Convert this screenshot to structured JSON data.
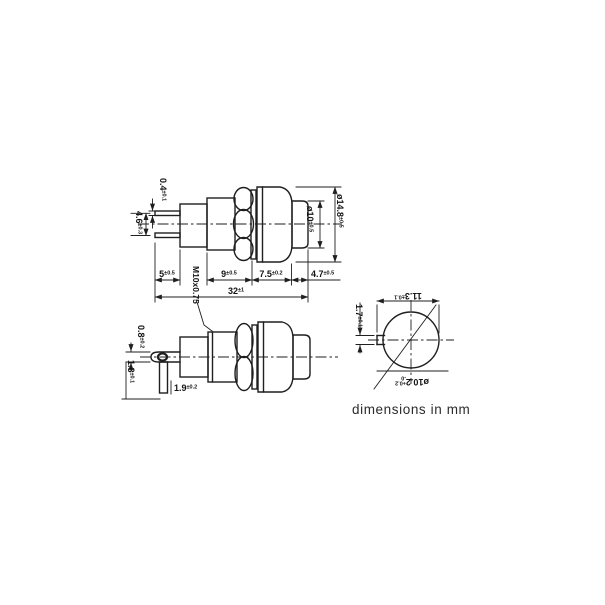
{
  "note": "dimensions in mm",
  "colors": {
    "ink": "#1f1f1f",
    "paper": "#ffffff"
  },
  "views": {
    "front_side_view": {
      "dims": {
        "terminal_thickness": {
          "v": "0.4",
          "t": "±0.1"
        },
        "terminal_spacing": {
          "v": "4.6",
          "t": "±0.3"
        },
        "terminal_length": {
          "v": "5",
          "t": "±0.5"
        },
        "thread_spec": {
          "v": "M10x0.75"
        },
        "thread_length": {
          "v": "9",
          "t": "±0.5"
        },
        "bezel_length": {
          "v": "7.5",
          "t": "±0.2"
        },
        "button_length": {
          "v": "4.7",
          "t": "±0.5"
        },
        "overall_length": {
          "v": "32",
          "t": "±1"
        },
        "bezel_diameter": {
          "v": "ø14.8",
          "t": "±0.5"
        },
        "button_diameter": {
          "v": "ø10",
          "t": "±0.5"
        }
      }
    },
    "rotated_side_view": {
      "dims": {
        "lug_thickness": {
          "v": "0.8",
          "t": "±0.2"
        },
        "lug_hole": {
          "v": "1.8",
          "t": "±0.1"
        },
        "lug_width": {
          "v": "1.9",
          "t": "±0.2"
        }
      }
    },
    "panel_cutout_view": {
      "dims": {
        "cutout_width": {
          "v": "11.3",
          "t": "±0.1"
        },
        "keyway_width": {
          "v": "1.7",
          "t": "±0.1"
        },
        "hole_diameter": {
          "v": "ø10.2",
          "t_hi": "+0.2",
          "t_lo": "-0"
        }
      }
    }
  }
}
